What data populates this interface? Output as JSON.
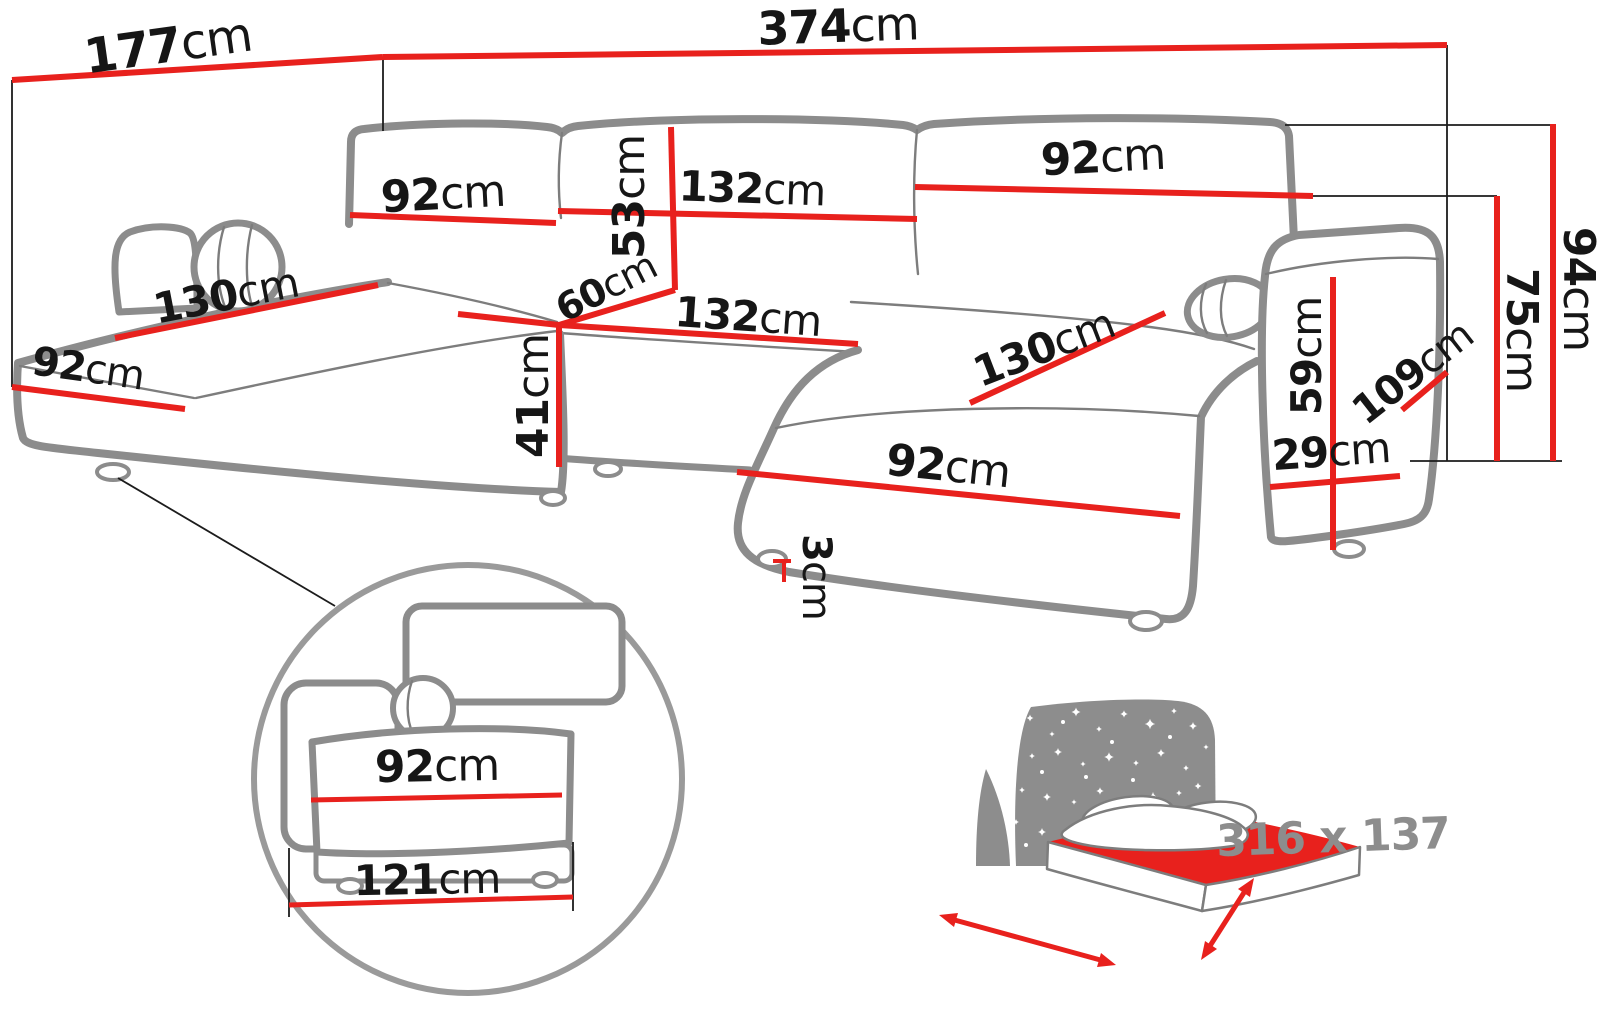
{
  "diagram_type": "sofa-dimension-diagram",
  "unit": "cm",
  "dims": {
    "left_depth": {
      "v": "177",
      "u": "cm"
    },
    "total_width": {
      "v": "374",
      "u": "cm"
    },
    "back_left": {
      "v": "92",
      "u": "cm"
    },
    "back_mid": {
      "v": "132",
      "u": "cm"
    },
    "back_right": {
      "v": "92",
      "u": "cm"
    },
    "backrest_h": {
      "v": "53",
      "u": "cm"
    },
    "seat_depth": {
      "v": "60",
      "u": "cm"
    },
    "left_len": {
      "v": "130",
      "u": "cm"
    },
    "left_width": {
      "v": "92",
      "u": "cm"
    },
    "mid_seat": {
      "v": "132",
      "u": "cm"
    },
    "seat_h": {
      "v": "41",
      "u": "cm"
    },
    "right_len": {
      "v": "130",
      "u": "cm"
    },
    "right_width": {
      "v": "92",
      "u": "cm"
    },
    "leg_h": {
      "v": "3",
      "u": "cm"
    },
    "arm_h": {
      "v": "59",
      "u": "cm"
    },
    "arm_w": {
      "v": "29",
      "u": "cm"
    },
    "arm_d": {
      "v": "109",
      "u": "cm"
    },
    "total_h": {
      "v": "94",
      "u": "cm"
    },
    "back_total_h": {
      "v": "75",
      "u": "cm"
    }
  },
  "inset": {
    "seat_front": {
      "v": "92",
      "u": "cm"
    },
    "base": {
      "v": "121",
      "u": "cm"
    }
  },
  "bed": {
    "size_label": "316 x 137"
  },
  "colors": {
    "dimension_line": "#e8211d",
    "artwork_outline": "#8c8c8c",
    "label_text": "#161616",
    "bed_icon_gray": "#8d8d8d",
    "background": "#ffffff"
  }
}
